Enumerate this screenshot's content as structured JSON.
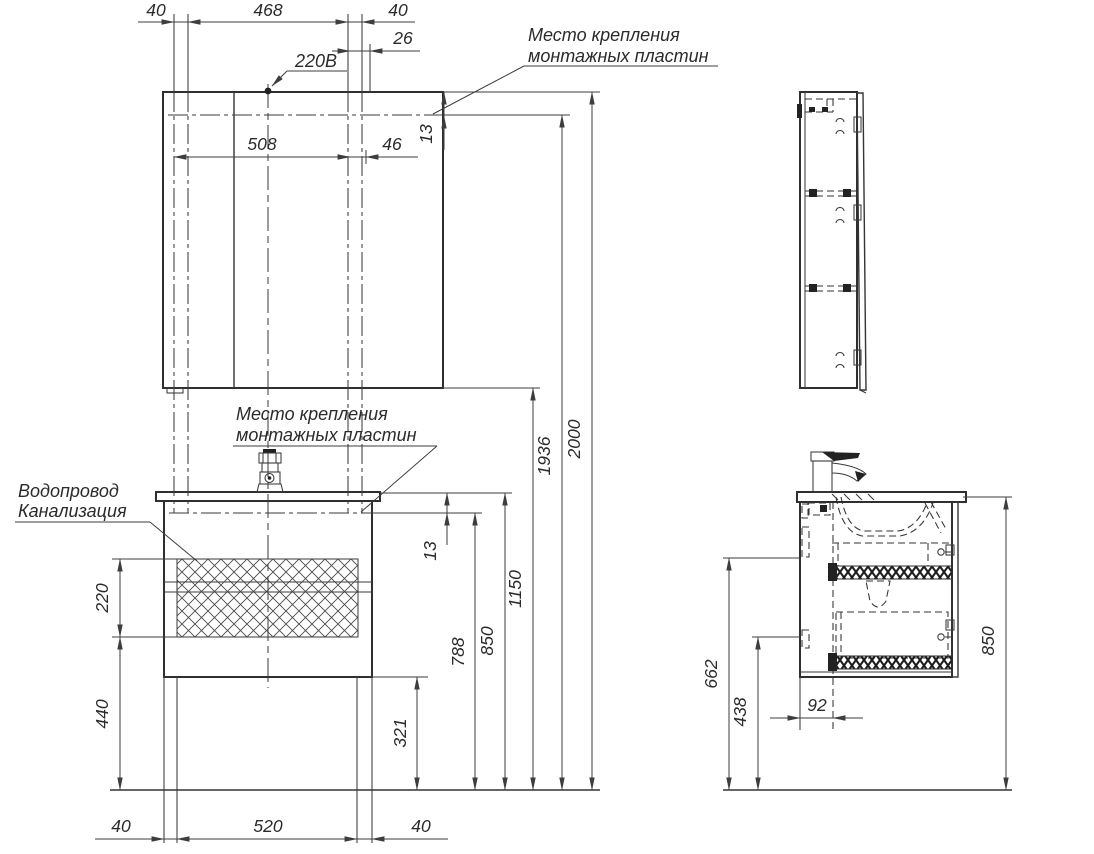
{
  "annotations": {
    "power_label": "220В",
    "mount_top_line1": "Место крепления",
    "mount_top_line2": "монтажных пластин",
    "mount_mid_line1": "Место крепления",
    "mount_mid_line2": "монтажных пластин",
    "water_line1": "Водопровод",
    "water_line2": "Канализация"
  },
  "dimensions": {
    "top_margin_left": "40",
    "top_span": "468",
    "top_margin_right": "40",
    "top_offset": "26",
    "plate_span": "508",
    "plate_right_offset": "46",
    "mirror_plate_inset": "13",
    "vanity_plate_inset": "13",
    "tech_zone_height": "220",
    "tech_zone_floor_offset": "440",
    "vanity_bottom_clearance": "321",
    "vanity_plate_height": "788",
    "counter_height": "850",
    "mirror_bottom_height": "1150",
    "mirror_plate_height": "1936",
    "mirror_top_height": "2000",
    "bottom_margin_left": "40",
    "bottom_span": "520",
    "bottom_margin_right": "40",
    "side_zone_top_height": "662",
    "side_zone_bottom_height": "438",
    "drain_wall_offset": "92",
    "side_counter_height": "850"
  }
}
